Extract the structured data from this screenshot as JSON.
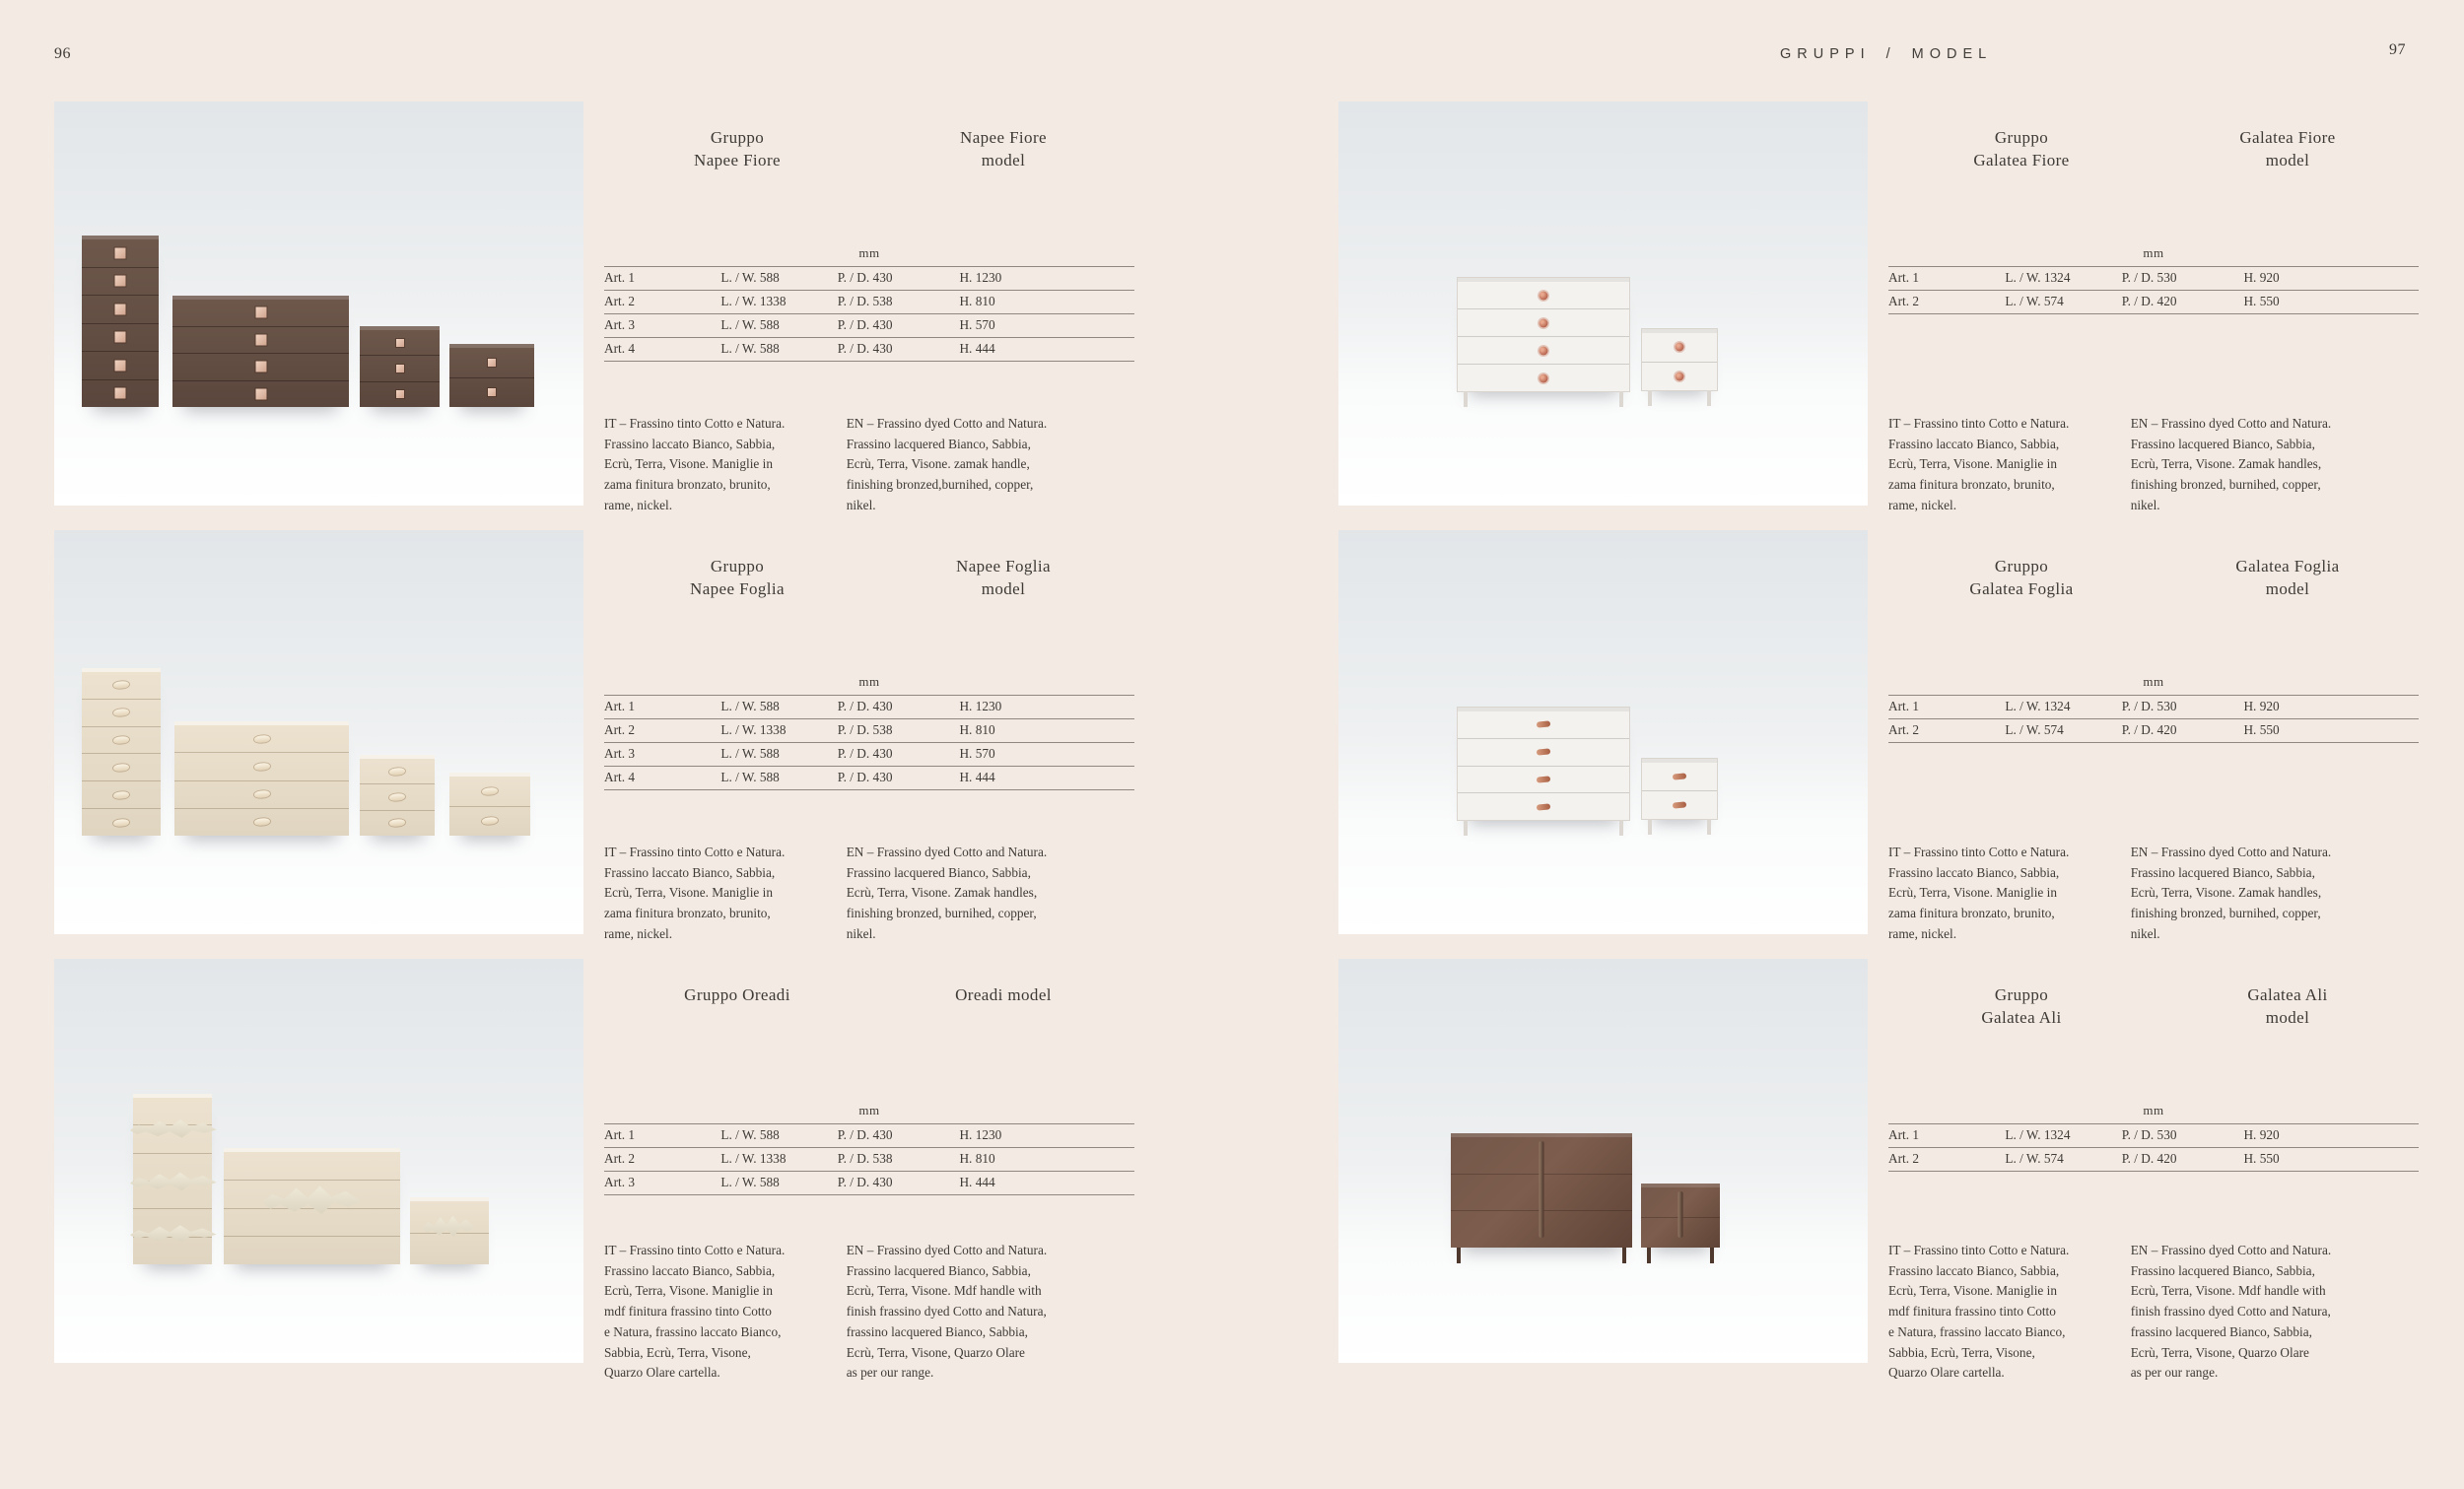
{
  "header": {
    "left_page_number": "96",
    "right_page_number": "97",
    "title": "GRUPPI / MODEL"
  },
  "colors": {
    "page_bg": "#f3eae3",
    "ink": "#3e3a36",
    "rule": "#8f8881",
    "photo_top": "#e2e6e9",
    "photo_bottom": "#ffffff",
    "wood_dark": "#644e43",
    "wood_cream": "#e8ddc9",
    "wood_white": "#f4f2ee",
    "wood_ali": "#6d5143",
    "handle_zamak": "#e4c4b1",
    "handle_copper": "#c07a5e",
    "ornament": "#e0d9c8"
  },
  "sections": [
    {
      "id": "napee-fiore",
      "title_it": "Gruppo\nNapee Fiore",
      "title_en": "Napee Fiore\nmodel",
      "unit": "mm",
      "table": [
        {
          "art": "Art. 1",
          "lw": "L. / W. 588",
          "pd": "P. / D. 430",
          "h": "H. 1230"
        },
        {
          "art": "Art. 2",
          "lw": "L. / W. 1338",
          "pd": "P. / D. 538",
          "h": "H. 810"
        },
        {
          "art": "Art. 3",
          "lw": "L. / W. 588",
          "pd": "P. / D. 430",
          "h": "H. 570"
        },
        {
          "art": "Art. 4",
          "lw": "L. / W. 588",
          "pd": "P. / D. 430",
          "h": "H. 444"
        }
      ],
      "desc_it": "IT – Frassino tinto Cotto e Natura.\nFrassino laccato Bianco, Sabbia,\nEcrù, Terra, Visone. Maniglie in\nzama finitura bronzato, brunito,\nrame, nickel.",
      "desc_en": "EN – Frassino dyed Cotto and Natura.\nFrassino lacquered Bianco, Sabbia,\nEcrù, Terra, Visone. zamak handle,\nfinishing bronzed,burnihed, copper,\nnikel."
    },
    {
      "id": "napee-foglia",
      "title_it": "Gruppo\nNapee Foglia",
      "title_en": "Napee Foglia\nmodel",
      "unit": "mm",
      "table": [
        {
          "art": "Art. 1",
          "lw": "L. / W. 588",
          "pd": "P. / D. 430",
          "h": "H. 1230"
        },
        {
          "art": "Art. 2",
          "lw": "L. / W. 1338",
          "pd": "P. / D. 538",
          "h": "H. 810"
        },
        {
          "art": "Art. 3",
          "lw": "L. / W. 588",
          "pd": "P. / D. 430",
          "h": "H. 570"
        },
        {
          "art": "Art. 4",
          "lw": "L. / W. 588",
          "pd": "P. / D. 430",
          "h": "H. 444"
        }
      ],
      "desc_it": "IT – Frassino tinto Cotto e Natura.\nFrassino laccato Bianco, Sabbia,\nEcrù, Terra, Visone. Maniglie in\nzama finitura bronzato, brunito,\nrame, nickel.",
      "desc_en": "EN – Frassino dyed Cotto and Natura.\nFrassino lacquered Bianco, Sabbia,\nEcrù, Terra, Visone. Zamak handles,\nfinishing bronzed, burnihed, copper,\nnikel."
    },
    {
      "id": "oreadi",
      "title_it": "Gruppo Oreadi",
      "title_en": "Oreadi model",
      "unit": "mm",
      "table": [
        {
          "art": "Art. 1",
          "lw": "L. / W. 588",
          "pd": "P. / D. 430",
          "h": "H. 1230"
        },
        {
          "art": "Art. 2",
          "lw": "L. / W. 1338",
          "pd": "P. / D. 538",
          "h": "H. 810"
        },
        {
          "art": "Art. 3",
          "lw": "L. / W. 588",
          "pd": "P. / D. 430",
          "h": "H. 444"
        }
      ],
      "desc_it": "IT – Frassino tinto Cotto e Natura.\nFrassino laccato Bianco, Sabbia,\nEcrù, Terra, Visone. Maniglie in\nmdf finitura frassino tinto Cotto\ne Natura, frassino laccato Bianco,\nSabbia, Ecrù, Terra, Visone,\nQuarzo Olare cartella.",
      "desc_en": "EN – Frassino dyed Cotto and Natura.\nFrassino lacquered Bianco, Sabbia,\nEcrù, Terra, Visone. Mdf handle with\nfinish frassino dyed Cotto and Natura,\nfrassino lacquered Bianco, Sabbia,\nEcrù, Terra, Visone, Quarzo Olare\nas per our range."
    },
    {
      "id": "galatea-fiore",
      "title_it": "Gruppo\nGalatea Fiore",
      "title_en": "Galatea Fiore\nmodel",
      "unit": "mm",
      "table": [
        {
          "art": "Art. 1",
          "lw": "L. / W. 1324",
          "pd": "P. / D. 530",
          "h": "H. 920"
        },
        {
          "art": "Art. 2",
          "lw": "L. / W. 574",
          "pd": "P. / D. 420",
          "h": "H. 550"
        }
      ],
      "desc_it": "IT – Frassino tinto Cotto e Natura.\nFrassino laccato Bianco, Sabbia,\nEcrù, Terra, Visone. Maniglie in\nzama finitura bronzato, brunito,\nrame, nickel.",
      "desc_en": "EN – Frassino dyed Cotto and Natura.\nFrassino lacquered Bianco, Sabbia,\nEcrù, Terra, Visone. Zamak handles,\nfinishing bronzed, burnihed, copper,\nnikel."
    },
    {
      "id": "galatea-foglia",
      "title_it": "Gruppo\nGalatea Foglia",
      "title_en": "Galatea Foglia\nmodel",
      "unit": "mm",
      "table": [
        {
          "art": "Art. 1",
          "lw": "L. / W. 1324",
          "pd": "P. / D. 530",
          "h": "H. 920"
        },
        {
          "art": "Art. 2",
          "lw": "L. / W. 574",
          "pd": "P. / D. 420",
          "h": "H. 550"
        }
      ],
      "desc_it": "IT – Frassino tinto Cotto e Natura.\nFrassino laccato Bianco, Sabbia,\nEcrù, Terra, Visone. Maniglie in\nzama finitura bronzato, brunito,\nrame, nickel.",
      "desc_en": "EN – Frassino dyed Cotto and Natura.\nFrassino lacquered Bianco, Sabbia,\nEcrù, Terra, Visone. Zamak handles,\nfinishing bronzed, burnihed, copper,\nnikel."
    },
    {
      "id": "galatea-ali",
      "title_it": "Gruppo\nGalatea Ali",
      "title_en": "Galatea Ali\nmodel",
      "unit": "mm",
      "table": [
        {
          "art": "Art. 1",
          "lw": "L. / W. 1324",
          "pd": "P. / D. 530",
          "h": "H. 920"
        },
        {
          "art": "Art. 2",
          "lw": "L. / W. 574",
          "pd": "P. / D. 420",
          "h": "H. 550"
        }
      ],
      "desc_it": "IT – Frassino tinto Cotto e Natura.\nFrassino laccato Bianco, Sabbia,\nEcrù, Terra, Visone. Maniglie in\nmdf finitura frassino tinto Cotto\ne Natura, frassino laccato Bianco,\nSabbia, Ecrù, Terra, Visone,\nQuarzo Olare cartella.",
      "desc_en": "EN – Frassino dyed Cotto and Natura.\nFrassino lacquered Bianco, Sabbia,\nEcrù, Terra, Visone. Mdf handle with\nfinish frassino dyed Cotto and Natura,\nfrassino lacquered Bianco, Sabbia,\nEcrù, Terra, Visone, Quarzo Olare\nas per our range."
    }
  ]
}
